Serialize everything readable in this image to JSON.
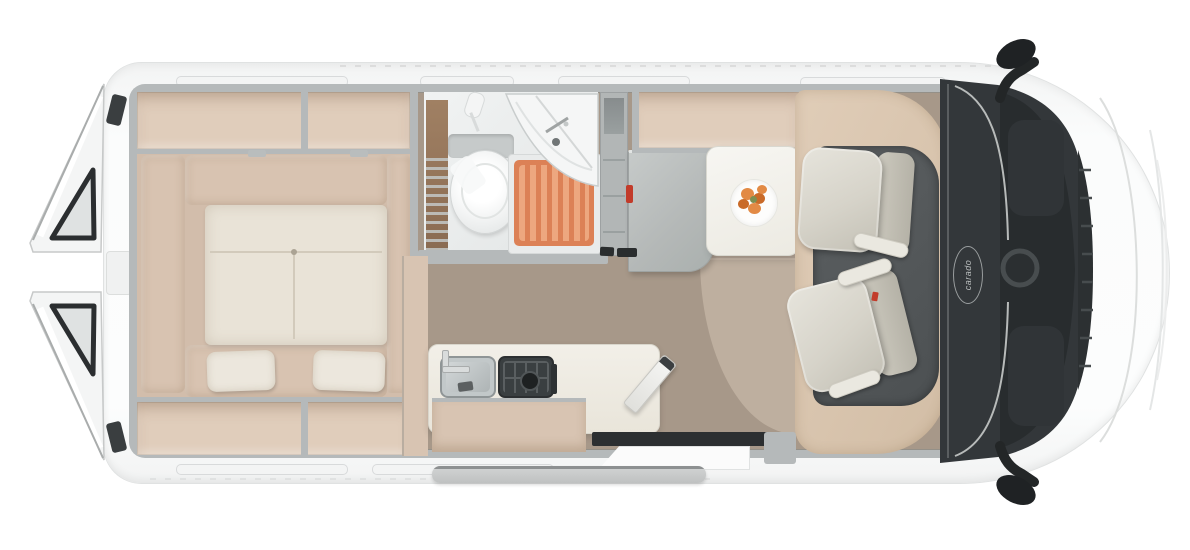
{
  "vehicle": {
    "brand_logo": "carado"
  },
  "palette": {
    "body_white": "#fafbfb",
    "body_edge": "#e0e2e2",
    "wall_gray": "#b5b9ba",
    "wall_dark": "#9da1a2",
    "locker_beige": "#e0cdbb",
    "cushion_beige": "#d8c3b1",
    "mattress_cream": "#e9e3d7",
    "pillow_cream": "#ece7dd",
    "floor_wood": "#a79889",
    "floor_wood_light": "#c3b4a4",
    "wood_brown": "#97775e",
    "shower_tray_orange": "#dc8156",
    "shower_slat_orange": "#eda77f",
    "fixture_white": "#f4f5f5",
    "wardrobe_gray": "#b2b6b6",
    "door_panel_gray": "#bcc0bf",
    "accent_red": "#c23b2a",
    "table_white": "#f5f4ef",
    "plate_white": "#fdfdfc",
    "food_orange": "#e28a45",
    "food_orange_dark": "#c96a28",
    "food_green": "#7c8f52",
    "counter_white": "#efece4",
    "cabinet_beige": "#d8c4b2",
    "sink_gray": "#c2c8c9",
    "hob_dark": "#3a3f41",
    "cab_surround_beige": "#d9c5ae",
    "cab_floor_gray": "#54585a",
    "seat_light": "#dcd9d0",
    "armrest_light": "#eae8e0",
    "dash_dark": "#33373a",
    "glass_dark": "#282c2e",
    "trim_silver": "#c6cac9",
    "mirror_black": "#212426",
    "slide_door_gray": "#c9cbcb",
    "threshold_dark": "#2c2f31"
  },
  "regions": [
    "rear-transverse-bed",
    "overhead-lockers",
    "bathroom",
    "toilet",
    "corner-washbasin",
    "shower-duckboard",
    "wardrobe-column",
    "open-bathroom-door",
    "dinette-table",
    "breakfast-plate",
    "kitchen-counter",
    "kitchen-sink",
    "gas-hob",
    "worktop-flap",
    "swivel-cab-seat-driver",
    "swivel-cab-seat-passenger",
    "cab-dashboard",
    "windshield",
    "hood",
    "side-mirrors",
    "open-rear-doors",
    "sliding-door",
    "entry-step",
    "wood-floor"
  ]
}
